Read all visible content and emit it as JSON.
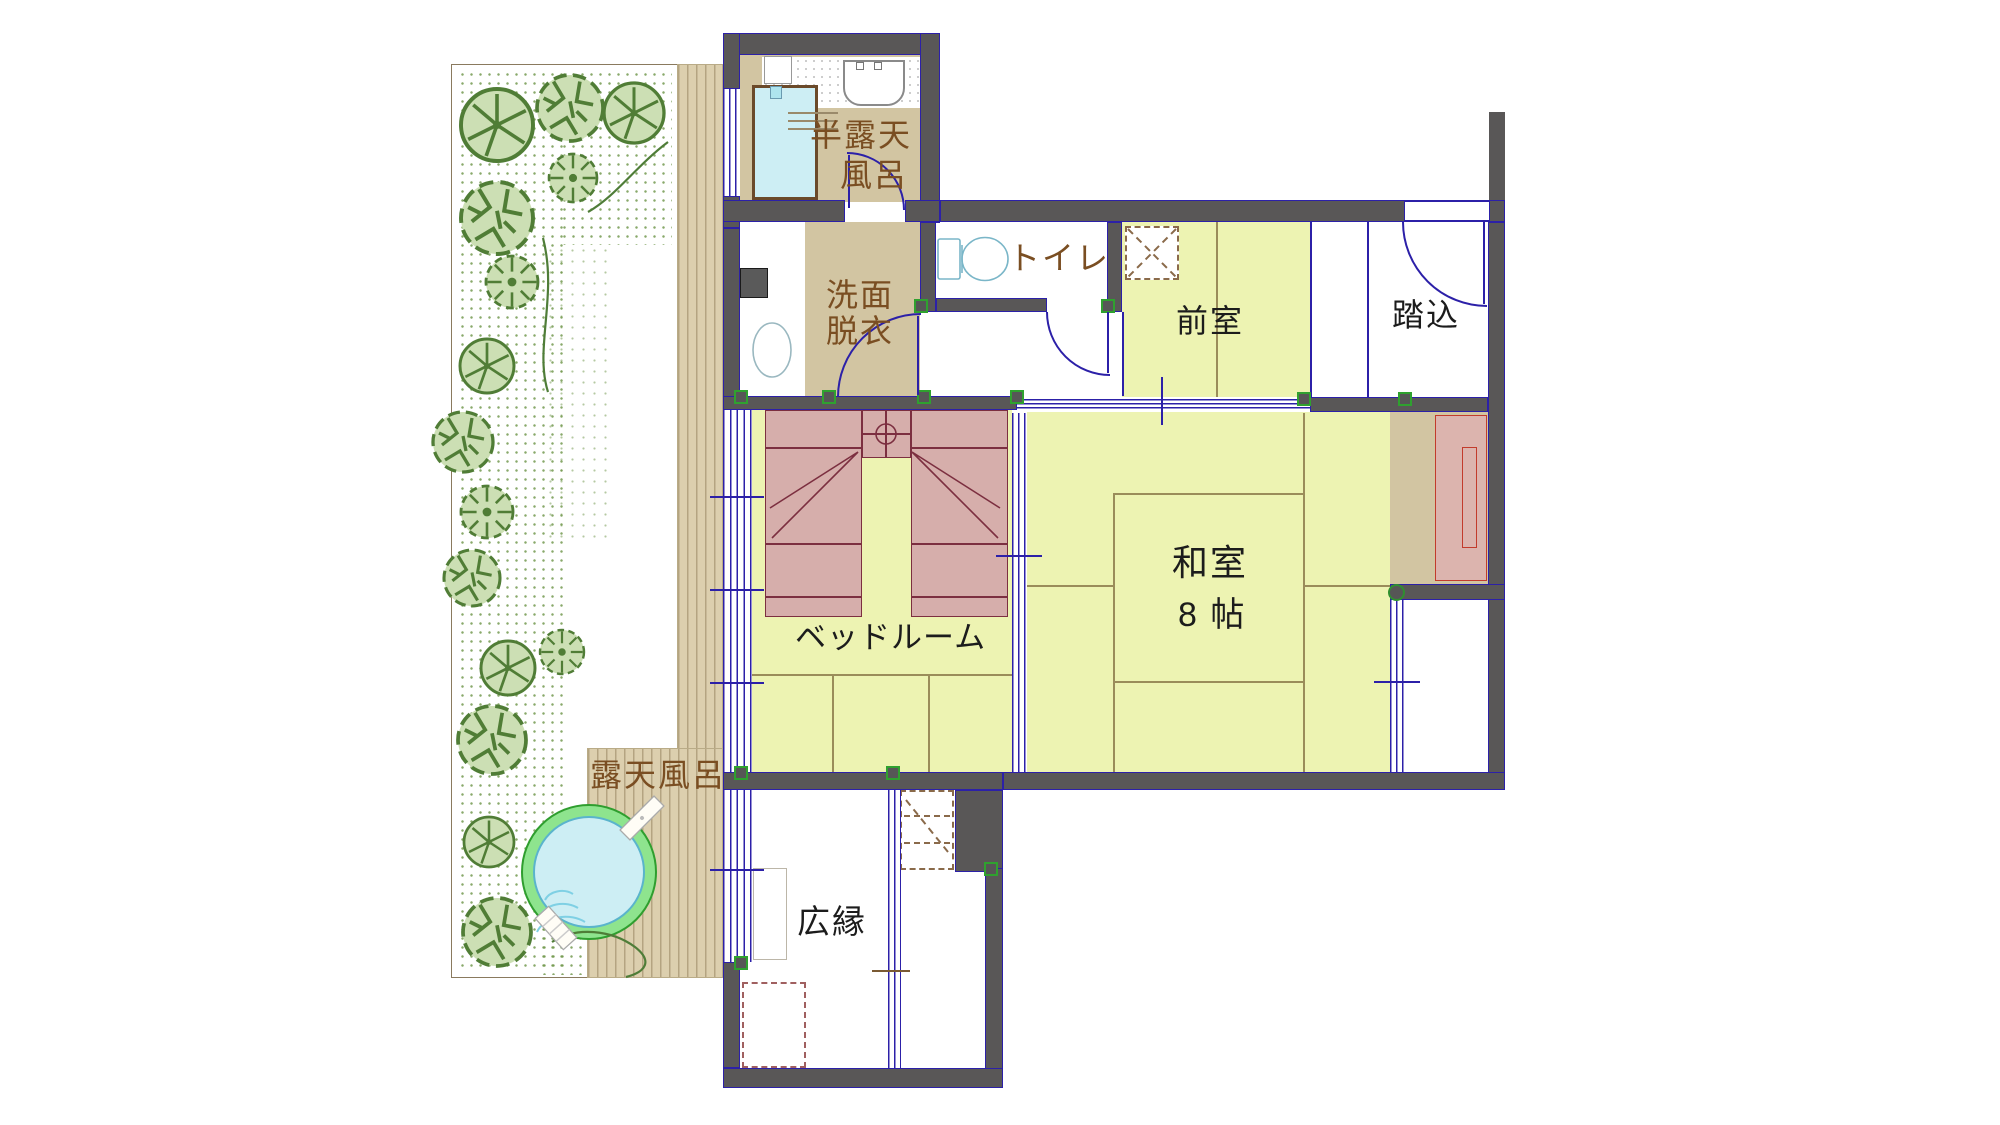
{
  "plan": {
    "rooms": {
      "han_rotenburo": {
        "lines": [
          "半露天",
          "風呂"
        ]
      },
      "senmen_datsui": {
        "lines": [
          "洗面",
          "脱衣"
        ]
      },
      "toire": {
        "label": "トイレ"
      },
      "zenshitsu": {
        "label": "前室"
      },
      "fumikomi": {
        "label": "踏込"
      },
      "washitsu": {
        "lines": [
          "和室",
          "8 帖"
        ]
      },
      "bedroom": {
        "label": "ベッドルーム"
      },
      "hiroen": {
        "label": "広縁"
      },
      "rotenburo": {
        "label": "露天風呂"
      }
    },
    "colors": {
      "wall": "#595757",
      "wall_outline": "#2c20a8",
      "tatami": "#edf3b2",
      "floor_tan": "#d2c5a2",
      "deck": "#dccfae",
      "bed": "#d6aeab",
      "bed_outline": "#7c2f40",
      "water": "#cdeef4",
      "bath_rim": "#8ee48e",
      "tree_fill": "#ccdfb4",
      "tree_stroke": "#507d36",
      "label_brown": "#7a4e22",
      "label_black": "#1c1c1c",
      "connector_green": "#2fa12f"
    }
  }
}
